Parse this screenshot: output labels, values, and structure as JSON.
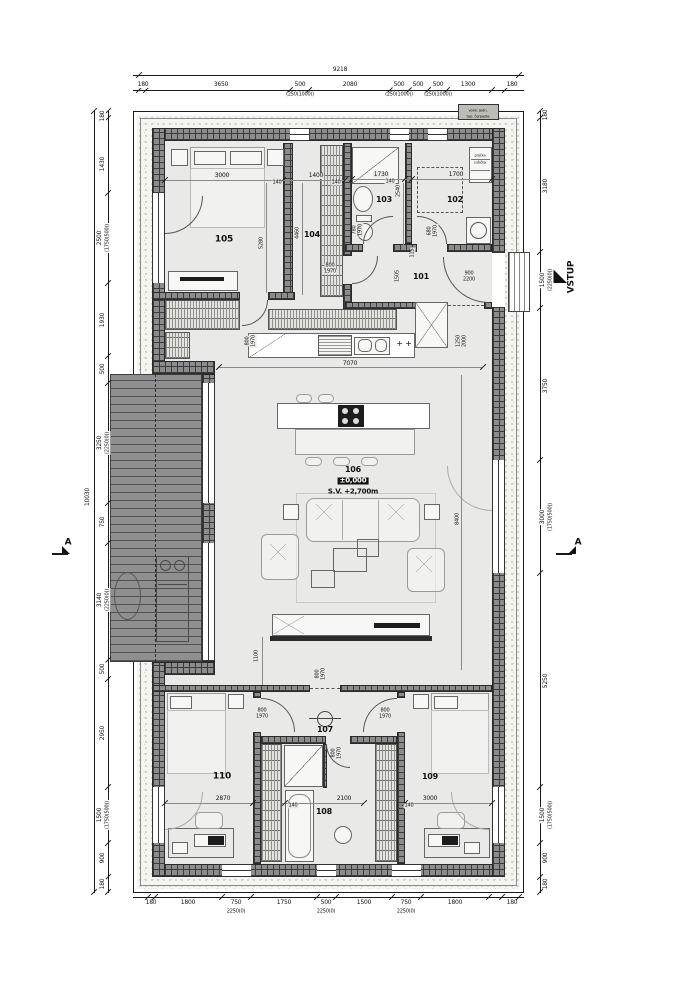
{
  "palette": {
    "line": "#1a1a1a",
    "wall": "#8c8c8c",
    "floor": "#e9e9e7",
    "terrace": "#8f8f8f",
    "stippleBg": "#f4f4f1",
    "hatchBg": "#e3e3df",
    "accent": "#111111"
  },
  "annotations": {
    "rooms": [
      {
        "n": "room-label-105",
        "t": "105",
        "x": 224,
        "y": 240,
        "s": 9,
        "b": 1
      },
      {
        "n": "room-label-104",
        "t": "104",
        "x": 312,
        "y": 235,
        "s": 8,
        "b": 1
      },
      {
        "n": "room-label-103",
        "t": "103",
        "x": 384,
        "y": 200,
        "s": 8,
        "b": 1
      },
      {
        "n": "room-label-102",
        "t": "102",
        "x": 455,
        "y": 200,
        "s": 8,
        "b": 1
      },
      {
        "n": "room-label-101",
        "t": "101",
        "x": 421,
        "y": 277,
        "s": 8,
        "b": 1
      },
      {
        "n": "room-label-106",
        "t": "106",
        "x": 353,
        "y": 470,
        "s": 8,
        "b": 1
      },
      {
        "n": "room-label-107",
        "t": "107",
        "x": 325,
        "y": 730,
        "s": 8,
        "b": 1
      },
      {
        "n": "room-label-108",
        "t": "108",
        "x": 324,
        "y": 812,
        "s": 8,
        "b": 1
      },
      {
        "n": "room-label-109",
        "t": "109",
        "x": 430,
        "y": 777,
        "s": 8,
        "b": 1
      },
      {
        "n": "room-label-110",
        "t": "110",
        "x": 222,
        "y": 777,
        "s": 9,
        "b": 1
      }
    ],
    "levels": [
      {
        "n": "level-value",
        "t": "±0,000",
        "x": 353,
        "y": 481,
        "s": 7,
        "b": 1,
        "inv": 1
      },
      {
        "n": "ceiling-height",
        "t": "S.V. +2,700m",
        "x": 353,
        "y": 492,
        "s": 7,
        "b": 1
      }
    ],
    "markers": [
      {
        "n": "entrance-label",
        "t": "VSTUP",
        "x": 572,
        "y": 277,
        "r": -90,
        "s": 9,
        "b": 1
      },
      {
        "n": "section-label-left",
        "t": "A",
        "x": 68,
        "y": 543,
        "s": 9,
        "b": 1
      },
      {
        "n": "section-label-right",
        "t": "A",
        "x": 578,
        "y": 543,
        "s": 9,
        "b": 1
      }
    ],
    "equipment": [
      {
        "n": "hp-unit-text-1",
        "t": "vonk. jedn.",
        "x": 478,
        "y": 111,
        "s": 5,
        "c": 0.75
      },
      {
        "n": "hp-unit-text-2",
        "t": "tep. čerpadla",
        "x": 478,
        "y": 117,
        "s": 5,
        "c": 0.75
      },
      {
        "n": "washer-text-1",
        "t": "práčka",
        "x": 480,
        "y": 156,
        "s": 5,
        "c": 0.7
      },
      {
        "n": "washer-text-2",
        "t": "sušička",
        "x": 480,
        "y": 163,
        "s": 5,
        "c": 0.7
      },
      {
        "n": "hob-symbol",
        "t": "+ +",
        "x": 404,
        "y": 344,
        "s": 8
      }
    ],
    "dims_top": [
      {
        "n": "dim-top-total",
        "t": "9218",
        "x": 340,
        "y": 70
      },
      {
        "t": "180",
        "x": 143,
        "y": 85
      },
      {
        "t": "3650",
        "x": 221,
        "y": 85
      },
      {
        "t": "500",
        "x": 300,
        "y": 85
      },
      {
        "t": "2080",
        "x": 350,
        "y": 85
      },
      {
        "t": "500",
        "x": 399,
        "y": 85
      },
      {
        "t": "500",
        "x": 418,
        "y": 85
      },
      {
        "t": "500",
        "x": 438,
        "y": 85
      },
      {
        "t": "1300",
        "x": 468,
        "y": 85
      },
      {
        "t": "180",
        "x": 512,
        "y": 85
      },
      {
        "t": "(250(1000))",
        "x": 300,
        "y": 95,
        "s": 5
      },
      {
        "t": "(250(1000))",
        "x": 399,
        "y": 95,
        "s": 5
      },
      {
        "t": "(250(1000))",
        "x": 438,
        "y": 95,
        "s": 5
      }
    ],
    "dims_bottom": [
      {
        "t": "180",
        "x": 151,
        "y": 903
      },
      {
        "t": "1800",
        "x": 188,
        "y": 903
      },
      {
        "t": "750",
        "x": 236,
        "y": 903
      },
      {
        "t": "1750",
        "x": 284,
        "y": 903
      },
      {
        "t": "500",
        "x": 326,
        "y": 903
      },
      {
        "t": "1500",
        "x": 364,
        "y": 903
      },
      {
        "t": "750",
        "x": 406,
        "y": 903
      },
      {
        "t": "1800",
        "x": 455,
        "y": 903
      },
      {
        "t": "180",
        "x": 512,
        "y": 903
      },
      {
        "t": "2250(0)",
        "x": 236,
        "y": 912,
        "s": 5
      },
      {
        "t": "2250(0)",
        "x": 326,
        "y": 912,
        "s": 5
      },
      {
        "t": "2250(0)",
        "x": 406,
        "y": 912,
        "s": 5
      }
    ],
    "dims_left": [
      {
        "n": "dim-left-total",
        "t": "10030",
        "x": 88,
        "y": 497,
        "r": -90
      },
      {
        "t": "180",
        "x": 103,
        "y": 116,
        "r": -90
      },
      {
        "t": "1430",
        "x": 103,
        "y": 164,
        "r": -90
      },
      {
        "t": "2500",
        "x": 100,
        "y": 238,
        "r": -90
      },
      {
        "t": "(1750(500))",
        "x": 108,
        "y": 238,
        "r": -90,
        "s": 5
      },
      {
        "t": "1930",
        "x": 103,
        "y": 320,
        "r": -90
      },
      {
        "t": "500",
        "x": 103,
        "y": 369,
        "r": -90
      },
      {
        "t": "3250",
        "x": 100,
        "y": 443,
        "r": -90
      },
      {
        "t": "(2250(0))",
        "x": 108,
        "y": 443,
        "r": -90,
        "s": 5
      },
      {
        "t": "750",
        "x": 103,
        "y": 522,
        "r": -90
      },
      {
        "t": "3140",
        "x": 100,
        "y": 600,
        "r": -90
      },
      {
        "t": "(2250(0))",
        "x": 108,
        "y": 600,
        "r": -90,
        "s": 5
      },
      {
        "t": "500",
        "x": 103,
        "y": 669,
        "r": -90
      },
      {
        "t": "2950",
        "x": 103,
        "y": 733,
        "r": -90
      },
      {
        "t": "1500",
        "x": 100,
        "y": 815,
        "r": -90
      },
      {
        "t": "(1750(500))",
        "x": 108,
        "y": 815,
        "r": -90,
        "s": 5
      },
      {
        "t": "900",
        "x": 103,
        "y": 858,
        "r": -90
      },
      {
        "t": "180",
        "x": 103,
        "y": 884,
        "r": -90
      }
    ],
    "dims_right": [
      {
        "t": "180",
        "x": 546,
        "y": 115,
        "r": -90
      },
      {
        "t": "3180",
        "x": 546,
        "y": 186,
        "r": -90
      },
      {
        "t": "1500",
        "x": 543,
        "y": 280,
        "r": -90
      },
      {
        "t": "(2250(0))",
        "x": 551,
        "y": 280,
        "r": -90,
        "s": 5
      },
      {
        "t": "3750",
        "x": 546,
        "y": 386,
        "r": -90
      },
      {
        "t": "3000",
        "x": 543,
        "y": 517,
        "r": -90
      },
      {
        "t": "(1750(500))",
        "x": 551,
        "y": 517,
        "r": -90,
        "s": 5
      },
      {
        "t": "5250",
        "x": 546,
        "y": 681,
        "r": -90
      },
      {
        "t": "1500",
        "x": 543,
        "y": 815,
        "r": -90
      },
      {
        "t": "(1750(500))",
        "x": 551,
        "y": 815,
        "r": -90,
        "s": 5
      },
      {
        "t": "900",
        "x": 546,
        "y": 858,
        "r": -90
      },
      {
        "t": "180",
        "x": 546,
        "y": 884,
        "r": -90
      }
    ],
    "dims_interior": [
      {
        "t": "3000",
        "x": 222,
        "y": 176
      },
      {
        "t": "140",
        "x": 277,
        "y": 183,
        "s": 5
      },
      {
        "t": "1400",
        "x": 316,
        "y": 176
      },
      {
        "t": "140",
        "x": 336,
        "y": 183,
        "s": 5
      },
      {
        "t": "5280",
        "x": 262,
        "y": 243,
        "r": -90,
        "s": 5
      },
      {
        "t": "4460",
        "x": 298,
        "y": 233,
        "r": -90,
        "s": 5
      },
      {
        "t": "1730",
        "x": 381,
        "y": 175
      },
      {
        "t": "140",
        "x": 390,
        "y": 182,
        "s": 5
      },
      {
        "t": "1700",
        "x": 456,
        "y": 175
      },
      {
        "t": "2540",
        "x": 399,
        "y": 191,
        "r": -90,
        "s": 5
      },
      {
        "t": "780",
        "x": 355,
        "y": 230,
        "r": -90,
        "s": 5
      },
      {
        "t": "1970",
        "x": 361,
        "y": 230,
        "r": -90,
        "s": 5
      },
      {
        "t": "680",
        "x": 430,
        "y": 231,
        "r": -90,
        "s": 5
      },
      {
        "t": "1970",
        "x": 436,
        "y": 231,
        "r": -90,
        "s": 5
      },
      {
        "t": "115",
        "x": 413,
        "y": 253,
        "r": -90,
        "s": 5
      },
      {
        "t": "1505",
        "x": 398,
        "y": 276,
        "r": -90,
        "s": 5
      },
      {
        "t": "900",
        "x": 469,
        "y": 274,
        "s": 5
      },
      {
        "t": "2200",
        "x": 469,
        "y": 280,
        "s": 5
      },
      {
        "t": "800",
        "x": 330,
        "y": 266,
        "s": 5
      },
      {
        "t": "1970",
        "x": 330,
        "y": 272,
        "s": 5
      },
      {
        "t": "800",
        "x": 248,
        "y": 341,
        "r": -90,
        "s": 5
      },
      {
        "t": "1970",
        "x": 254,
        "y": 341,
        "r": -90,
        "s": 5
      },
      {
        "t": "7070",
        "x": 350,
        "y": 364
      },
      {
        "t": "1250",
        "x": 459,
        "y": 341,
        "r": -90,
        "s": 5
      },
      {
        "t": "2000",
        "x": 465,
        "y": 341,
        "r": -90,
        "s": 5
      },
      {
        "t": "8400",
        "x": 458,
        "y": 519,
        "r": -90,
        "s": 5
      },
      {
        "t": "1100",
        "x": 257,
        "y": 656,
        "r": -90,
        "s": 5
      },
      {
        "t": "800",
        "x": 318,
        "y": 674,
        "r": -90,
        "s": 5
      },
      {
        "t": "1970",
        "x": 324,
        "y": 674,
        "r": -90,
        "s": 5
      },
      {
        "t": "800",
        "x": 262,
        "y": 711,
        "s": 5
      },
      {
        "t": "1970",
        "x": 262,
        "y": 717,
        "s": 5
      },
      {
        "t": "800",
        "x": 385,
        "y": 711,
        "s": 5
      },
      {
        "t": "1970",
        "x": 385,
        "y": 717,
        "s": 5
      },
      {
        "t": "800",
        "x": 334,
        "y": 753,
        "r": -90,
        "s": 5
      },
      {
        "t": "1970",
        "x": 340,
        "y": 753,
        "r": -90,
        "s": 5
      },
      {
        "t": "2870",
        "x": 223,
        "y": 799
      },
      {
        "t": "140",
        "x": 293,
        "y": 806,
        "s": 5
      },
      {
        "t": "2100",
        "x": 344,
        "y": 799
      },
      {
        "t": "140",
        "x": 409,
        "y": 806,
        "s": 5
      },
      {
        "t": "3000",
        "x": 430,
        "y": 799
      }
    ]
  }
}
